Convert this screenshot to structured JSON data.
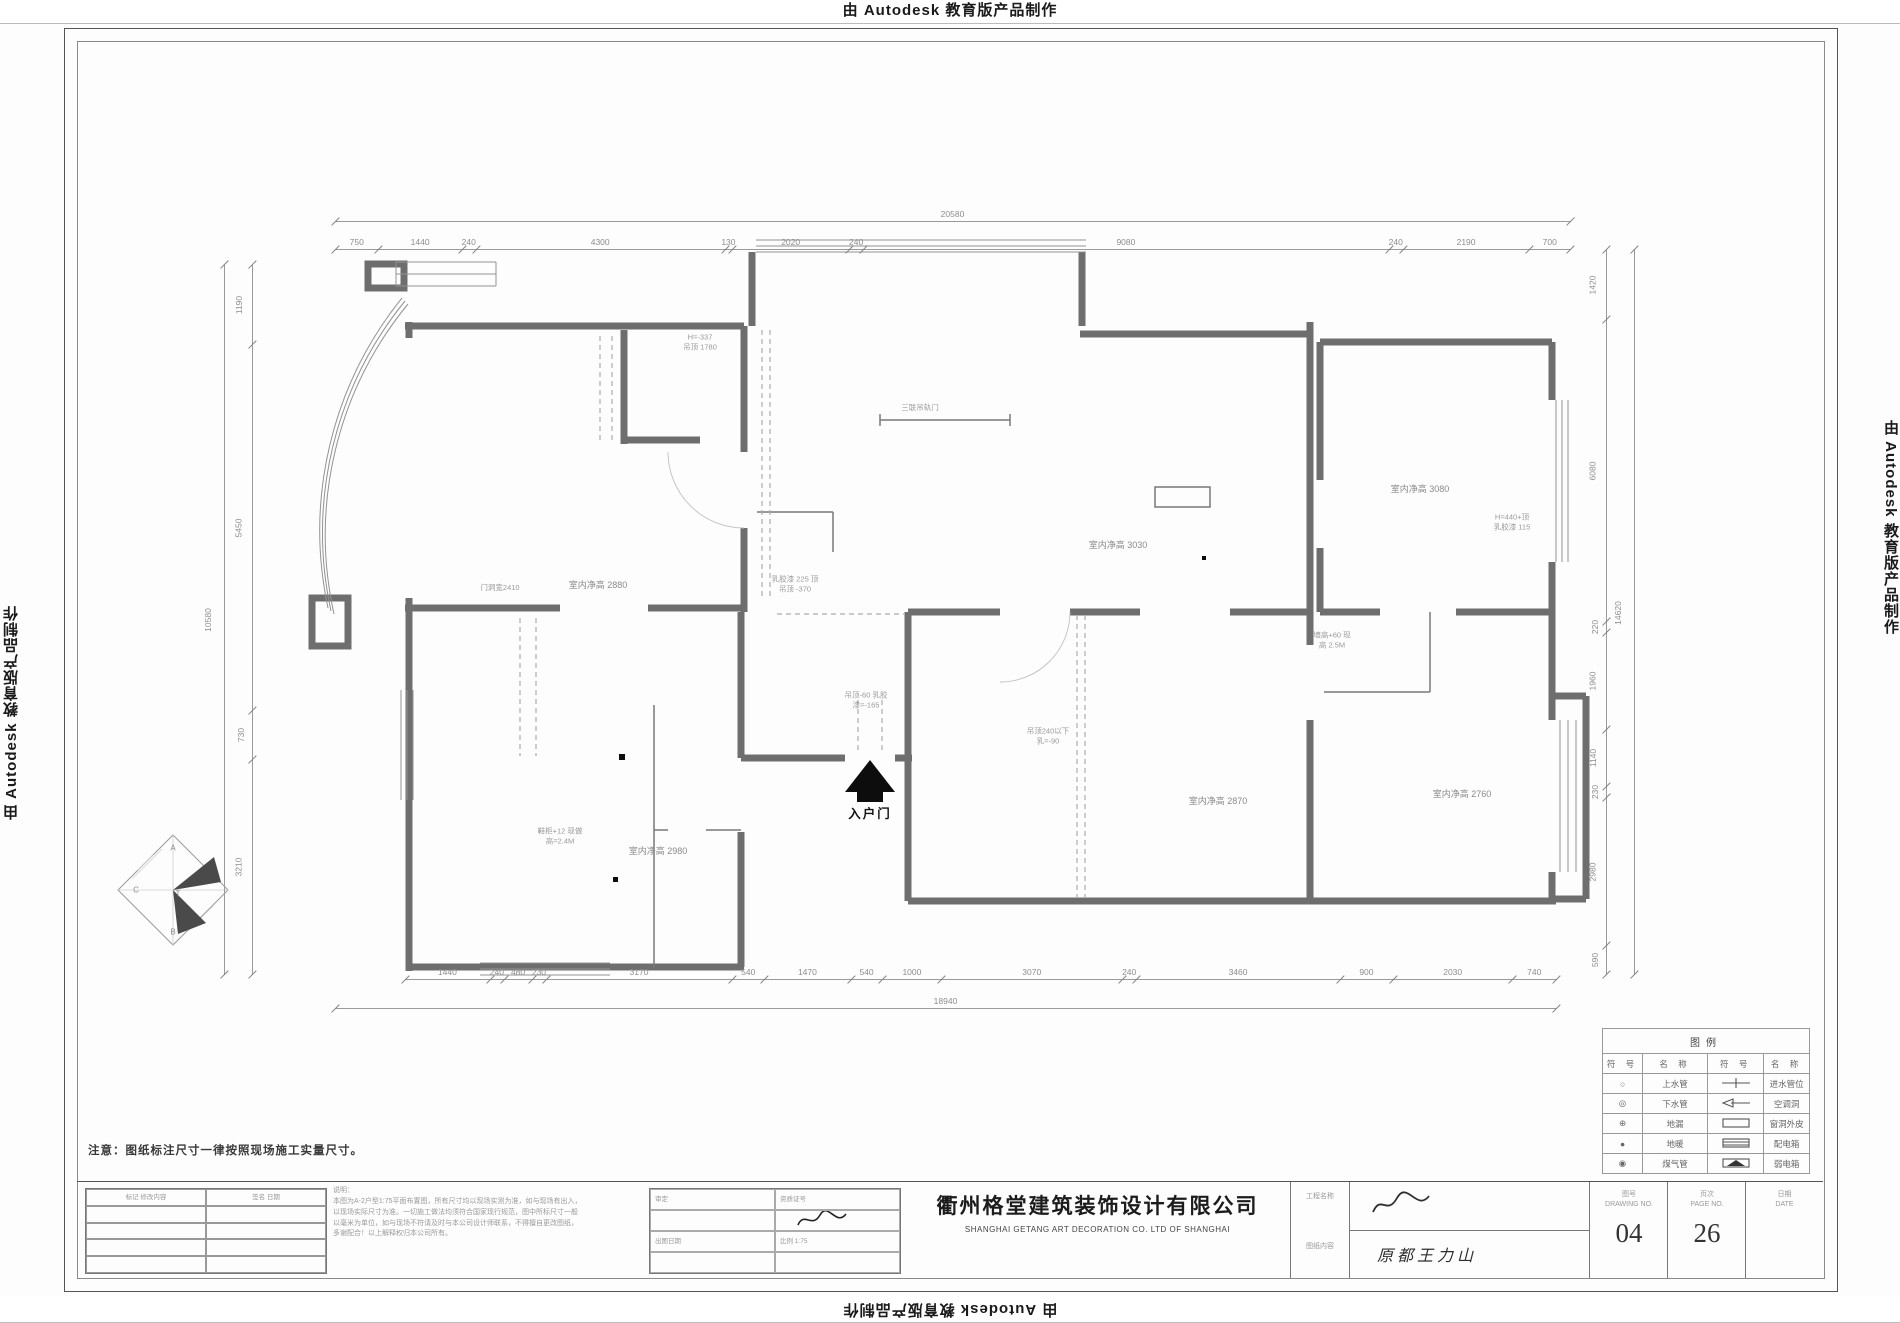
{
  "watermark": {
    "text": "由 Autodesk 教育版产品制作"
  },
  "note": "注意：图纸标注尺寸一律按照现场施工实量尺寸。",
  "dims": {
    "top": {
      "values": [
        "750",
        "1440",
        "240",
        "4300",
        "130",
        "2020",
        "240",
        "9080",
        "240",
        "2190",
        "700"
      ]
    },
    "top_total": {
      "values": [
        "20580"
      ]
    },
    "bottom": {
      "values": [
        "1440",
        "240",
        "480",
        "230",
        "3170",
        "540",
        "1470",
        "540",
        "1000",
        "3070",
        "240",
        "3460",
        "900",
        "2030",
        "740"
      ]
    },
    "bottom_total": {
      "values": [
        "18940"
      ]
    },
    "left": {
      "values": [
        "1190",
        "5450",
        "730",
        "3210"
      ]
    },
    "left_total": {
      "values": [
        "10580"
      ]
    },
    "right": {
      "values": [
        "1420",
        "6080",
        "220",
        "1960",
        "1140",
        "230",
        "2980",
        "590"
      ]
    },
    "right_total": {
      "values": [
        "14620"
      ]
    }
  },
  "plan": {
    "entry_label": "入户门",
    "logo_letters": [
      "A",
      "C",
      "T",
      "B"
    ],
    "labels": [
      {
        "x": 500,
        "y": 588,
        "cls": "tiny",
        "t": [
          "门洞宽2410"
        ]
      },
      {
        "x": 598,
        "y": 586,
        "cls": "",
        "t": [
          "室内净高 2880"
        ]
      },
      {
        "x": 795,
        "y": 584,
        "cls": "tiny",
        "t": [
          "乳胶漆 225 顶",
          "吊顶 -370"
        ]
      },
      {
        "x": 700,
        "y": 342,
        "cls": "tiny",
        "t": [
          "H=-337",
          "吊顶 1780"
        ]
      },
      {
        "x": 920,
        "y": 408,
        "cls": "tiny",
        "t": [
          "三联吊轨门"
        ]
      },
      {
        "x": 1118,
        "y": 546,
        "cls": "",
        "t": [
          "室内净高 3030"
        ]
      },
      {
        "x": 1420,
        "y": 490,
        "cls": "",
        "t": [
          "室内净高 3080"
        ]
      },
      {
        "x": 1512,
        "y": 522,
        "cls": "tiny",
        "t": [
          "H=440+顶",
          "乳胶漆 115"
        ]
      },
      {
        "x": 1332,
        "y": 640,
        "cls": "tiny",
        "t": [
          "墙高+60 现",
          "高 2.5M"
        ]
      },
      {
        "x": 1048,
        "y": 736,
        "cls": "tiny",
        "t": [
          "吊顶240以下",
          "乳=-90"
        ]
      },
      {
        "x": 866,
        "y": 700,
        "cls": "tiny",
        "t": [
          "吊顶-60 乳胶",
          "漆=-165"
        ]
      },
      {
        "x": 560,
        "y": 836,
        "cls": "tiny",
        "t": [
          "鞋柜+12 现做",
          "高=2.4M"
        ]
      },
      {
        "x": 658,
        "y": 852,
        "cls": "",
        "t": [
          "室内净高 2980"
        ]
      },
      {
        "x": 1218,
        "y": 802,
        "cls": "",
        "t": [
          "室内净高 2870"
        ]
      },
      {
        "x": 1462,
        "y": 795,
        "cls": "",
        "t": [
          "室内净高 2760"
        ]
      }
    ]
  },
  "legend": {
    "title": "图例",
    "headers": [
      "符 号",
      "名 称",
      "符 号",
      "名 称"
    ],
    "rows": [
      {
        "s1": "○",
        "n1": "上水管",
        "g": "tee",
        "n2": "进水管位"
      },
      {
        "s1": "◎",
        "n1": "下水管",
        "g": "arrow",
        "n2": "空调洞"
      },
      {
        "s1": "⊕",
        "n1": "地漏",
        "g": "rect",
        "n2": "窗洞外皮"
      },
      {
        "s1": "●",
        "n1": "地暖",
        "g": "hatch",
        "n2": "配电箱"
      },
      {
        "s1": "◉",
        "n1": "煤气管",
        "g": "tri",
        "n2": "弱电箱"
      }
    ]
  },
  "titleblock": {
    "company_cn": "衢州格堂建筑装饰设计有限公司",
    "company_en": "SHANGHAI GETANG ART DECORATION CO. LTD OF SHANGHAI",
    "rev_headers": [
      "标记  修改内容",
      "签名  日期"
    ],
    "notes_title": "说明：",
    "notes": [
      "本图为A-2户型1:75平面布置图，所有尺寸均以现场实测为准，如与现场有出入，",
      "以现场实际尺寸为准。一切施工做法均须符合国家现行规范，图中所标尺寸一般",
      "以毫米为单位，如与现场不符请及时与本公司设计师联系，不得擅自更改图纸，",
      "多谢配合！以上解释权归本公司所有。"
    ],
    "mid_labels": {
      "approve": "审定",
      "cert": "资质证号",
      "date": "出图日期",
      "scale": "比例 1:75"
    },
    "proj_label": "工程名称",
    "sheet_label": "图纸内容",
    "sheet_value": "原都王力山",
    "boxes": [
      {
        "label": "图号",
        "sub": "DRAWING NO.",
        "value": "04"
      },
      {
        "label": "页次",
        "sub": "PAGE NO.",
        "value": "26"
      },
      {
        "label": "日期",
        "sub": "DATE",
        "value": ""
      }
    ]
  }
}
